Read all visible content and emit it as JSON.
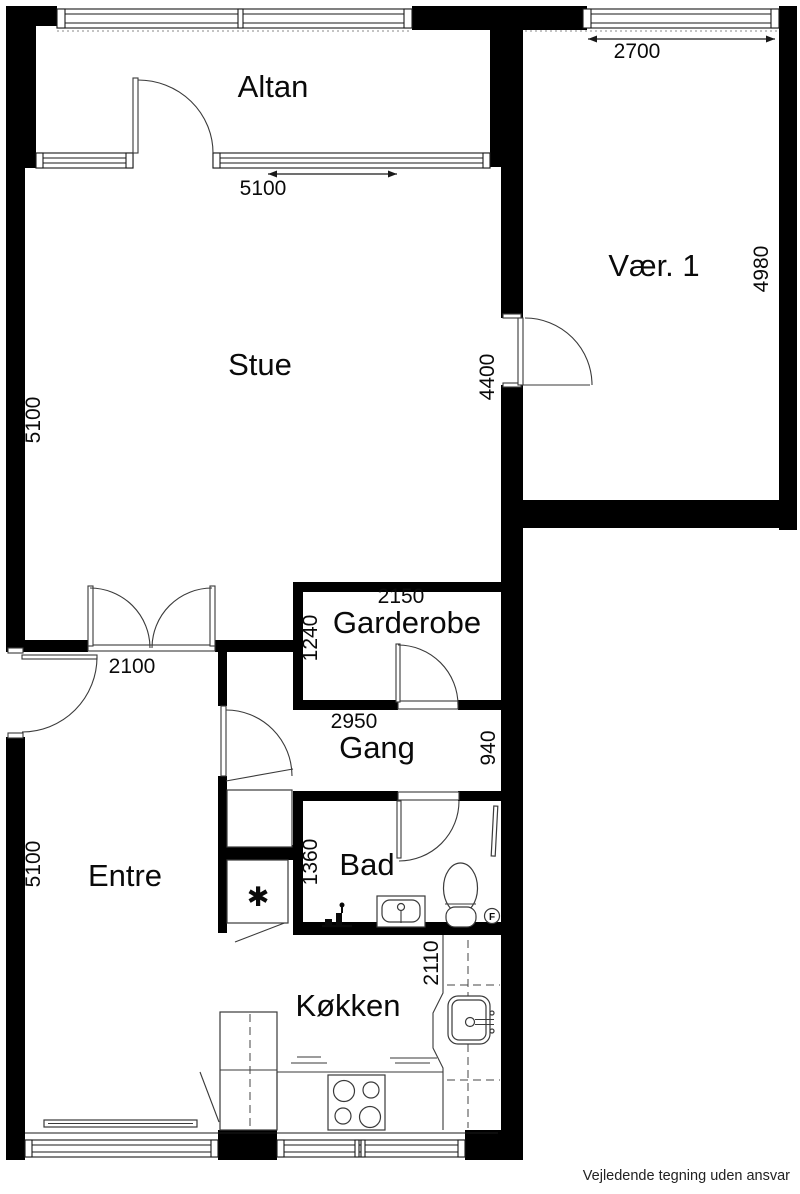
{
  "labels": {
    "altan": "Altan",
    "stue": "Stue",
    "vaer1": "Vær. 1",
    "garderobe": "Garderobe",
    "gang": "Gang",
    "entre": "Entre",
    "bad": "Bad",
    "koekken": "Køkken"
  },
  "dims": {
    "altan_width": "5100",
    "vaer1_width": "2700",
    "vaer1_height": "4980",
    "stue_height": "5100",
    "stue_door": "4400",
    "garderobe_width": "2150",
    "garderobe_depth": "1240",
    "stue_opening": "2100",
    "gang_width": "2950",
    "gang_depth": "940",
    "bad_depth": "1360",
    "entre_height": "5100",
    "koekken_width": "2110"
  },
  "symbols": {
    "floor_drain": "F",
    "shaft": "✱"
  },
  "footer": {
    "disclaimer": "Vejledende tegning uden ansvar"
  },
  "colors": {
    "wall": "#000000",
    "fixture_line": "#3a3a3a",
    "background": "#ffffff"
  }
}
